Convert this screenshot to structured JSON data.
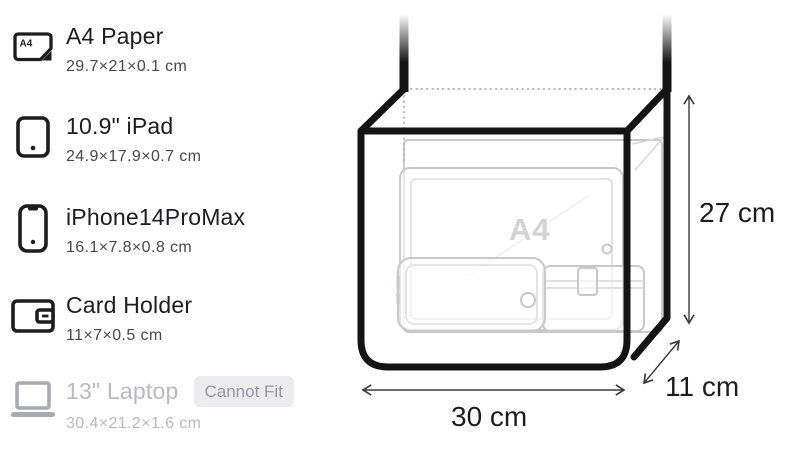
{
  "sidebar": {
    "items": [
      {
        "icon": "a4-paper-icon",
        "icon_label": "A4",
        "title": "A4 Paper",
        "dimensions": "29.7×21×0.1 cm",
        "fits": true
      },
      {
        "icon": "ipad-icon",
        "title": "10.9\" iPad",
        "dimensions": "24.9×17.9×0.7 cm",
        "fits": true
      },
      {
        "icon": "iphone-icon",
        "title": "iPhone14ProMax",
        "dimensions": "16.1×7.8×0.8 cm",
        "fits": true
      },
      {
        "icon": "card-holder-icon",
        "title": "Card Holder",
        "dimensions": "11×7×0.5 cm",
        "fits": true
      },
      {
        "icon": "laptop-icon",
        "title": "13\" Laptop",
        "dimensions": "30.4×21.2×1.6 cm",
        "fits": false,
        "badge": "Cannot Fit"
      }
    ]
  },
  "diagram": {
    "watermark": "A4",
    "width_label": "30 cm",
    "height_label": "27 cm",
    "depth_label": "11 cm",
    "bag_dimensions_cm": {
      "width": 30,
      "height": 27,
      "depth": 11
    },
    "items_shown_inside": [
      "A4 Paper",
      "10.9\" iPad",
      "iPhone14ProMax",
      "Card Holder"
    ]
  },
  "colors": {
    "bag_outline": "#141414",
    "item_outline": "#c7c7cd",
    "disabled_text": "#b9b9c0",
    "badge_background": "#ececef",
    "badge_text": "#97979e"
  }
}
